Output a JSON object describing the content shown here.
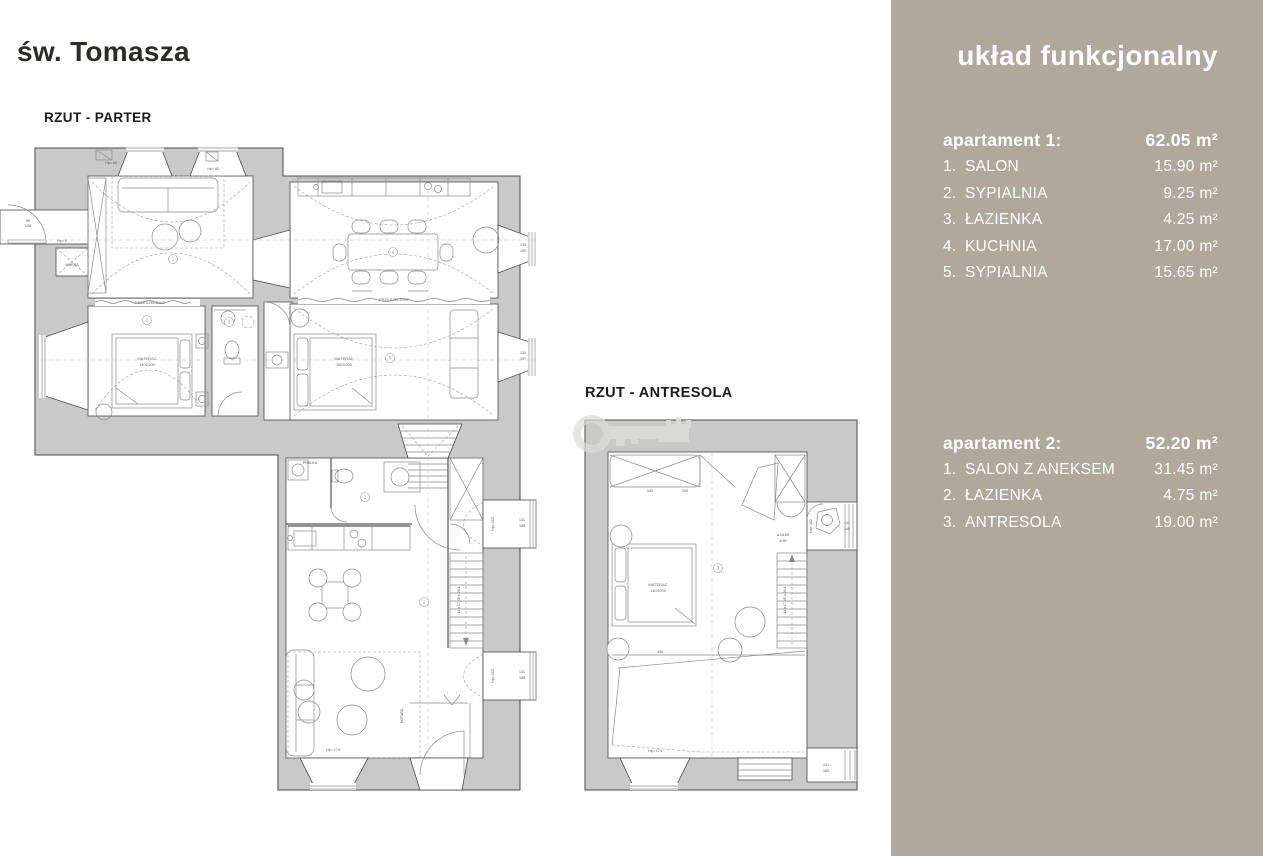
{
  "page": {
    "title": "św. Tomasza",
    "background": "#ffffff"
  },
  "colors": {
    "sidebar_bg": "#afa89b",
    "sidebar_text": "#ffffff",
    "title_text": "#2d2b28",
    "wall_fill": "#c9c9c9",
    "plan_line": "#4a4a4a"
  },
  "plans": {
    "parter": {
      "title": "RZUT - PARTER",
      "markers": [
        "1",
        "2",
        "3",
        "4",
        "5"
      ],
      "wing_markers": [
        "1",
        "2"
      ],
      "labels": {
        "przeszklenie": "PRZESZKLENIE",
        "materac": "MATERAC",
        "size_140": "140X200",
        "size_180": "180X200",
        "pralka": "PRALKA",
        "wneka": "WNĘKA",
        "kotara": "KOTARA",
        "hp0": "Hp= 0",
        "hp88": "Hp= 88",
        "hp85": "Hp= 85",
        "hp162": "Hp= 162",
        "hp174": "Hp= 174",
        "stair_note": "11 x 17,45 x 26,1"
      },
      "dims": {
        "entry_w": "98",
        "entry_h": "128",
        "kitchen_bay_w": "133",
        "kitchen_bay_h": "190",
        "bedroom_bay_w": "134",
        "bedroom_bay_h": "197",
        "wing_bay_w": "131",
        "wing_bay_h": "165"
      }
    },
    "antresola": {
      "title": "RZUT - ANTRESOLA",
      "marker": "3",
      "labels": {
        "materac": "MATERAC",
        "size_140": "140X200",
        "hp162": "Hp= 162",
        "hp174": "Hp= 174",
        "stair_note": "11 x 17,45 x 26,1",
        "note_a1": "a 16,65",
        "note_a2": "a 55"
      },
      "dims": {
        "wardrobe_1": "245",
        "wardrobe_2": "340",
        "bath_bay_w": "131",
        "bath_bay_h": "145",
        "lower_bay_w": "131",
        "lower_bay_h": "165",
        "void": "445"
      }
    }
  },
  "sidebar": {
    "heading": "układ funkcjonalny",
    "apartments": [
      {
        "name": "apartament 1:",
        "total_area": "62.05 m²",
        "rooms": [
          {
            "num": "1.",
            "label": "SALON",
            "area": "15.90 m²"
          },
          {
            "num": "2.",
            "label": "SYPIALNIA",
            "area": "9.25 m²"
          },
          {
            "num": "3.",
            "label": "ŁAZIENKA",
            "area": "4.25 m²"
          },
          {
            "num": "4.",
            "label": "KUCHNIA",
            "area": "17.00 m²"
          },
          {
            "num": "5.",
            "label": "SYPIALNIA",
            "area": "15.65 m²"
          }
        ]
      },
      {
        "name": "apartament 2:",
        "total_area": "52.20 m²",
        "rooms": [
          {
            "num": "1.",
            "label": "SALON Z ANEKSEM",
            "area": "31.45 m²"
          },
          {
            "num": "2.",
            "label": "ŁAZIENKA",
            "area": "4.75 m²"
          },
          {
            "num": "3.",
            "label": "ANTRESOLA",
            "area": "19.00 m²"
          }
        ]
      }
    ]
  }
}
